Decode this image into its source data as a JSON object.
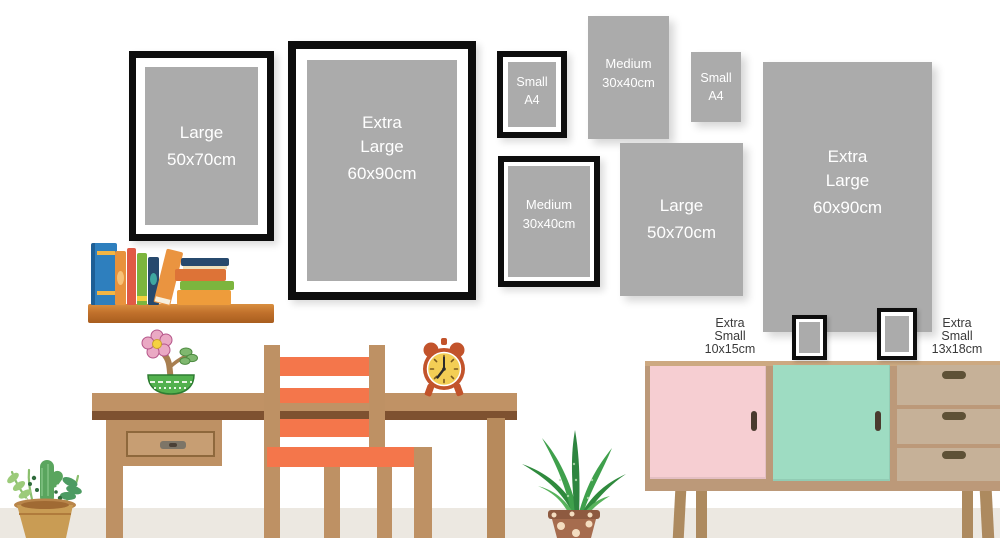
{
  "title": "Picture frame size guide wall illustration",
  "frames": {
    "large_left": {
      "lines": [
        "Large",
        "50x70cm"
      ]
    },
    "extra_large_left": {
      "lines": [
        "Extra",
        "Large",
        "60x90cm"
      ]
    },
    "small_a4_framed": {
      "lines": [
        "Small",
        "A4"
      ]
    },
    "medium_print": {
      "lines": [
        "Medium",
        "30x40cm"
      ]
    },
    "small_a4_print": {
      "lines": [
        "Small",
        "A4"
      ]
    },
    "medium_framed": {
      "lines": [
        "Medium",
        "30x40cm"
      ]
    },
    "large_print": {
      "lines": [
        "Large",
        "50x70cm"
      ]
    },
    "extra_large_print": {
      "lines": [
        "Extra",
        "Large",
        "60x90cm"
      ]
    }
  },
  "captions": {
    "extra_small_left": {
      "lines": [
        "Extra",
        "Small",
        "10x15cm"
      ]
    },
    "extra_small_right": {
      "lines": [
        "Extra",
        "Small",
        "13x18cm"
      ]
    }
  },
  "colors": {
    "frame_black": "#0d0d0d",
    "frame_mat": "#ffffff",
    "print_gray": "#ababab",
    "label_text": "#ffffff",
    "caption_text": "#3a3a3a",
    "wood_tan": "#c09265",
    "wood_dark_edge": "#7e5130",
    "chair_orange": "#f4764b",
    "shelf_wood": "#c1712c",
    "sideboard_tan": "#bc9979",
    "door_pink": "#f6ced2",
    "door_mint": "#9edcc2",
    "drawer_beige": "#c6b198",
    "clock_red": "#c2532b",
    "clock_face_yellow": "#f3ce55",
    "floor": "#ece8e1",
    "wall": "#ffffff"
  }
}
